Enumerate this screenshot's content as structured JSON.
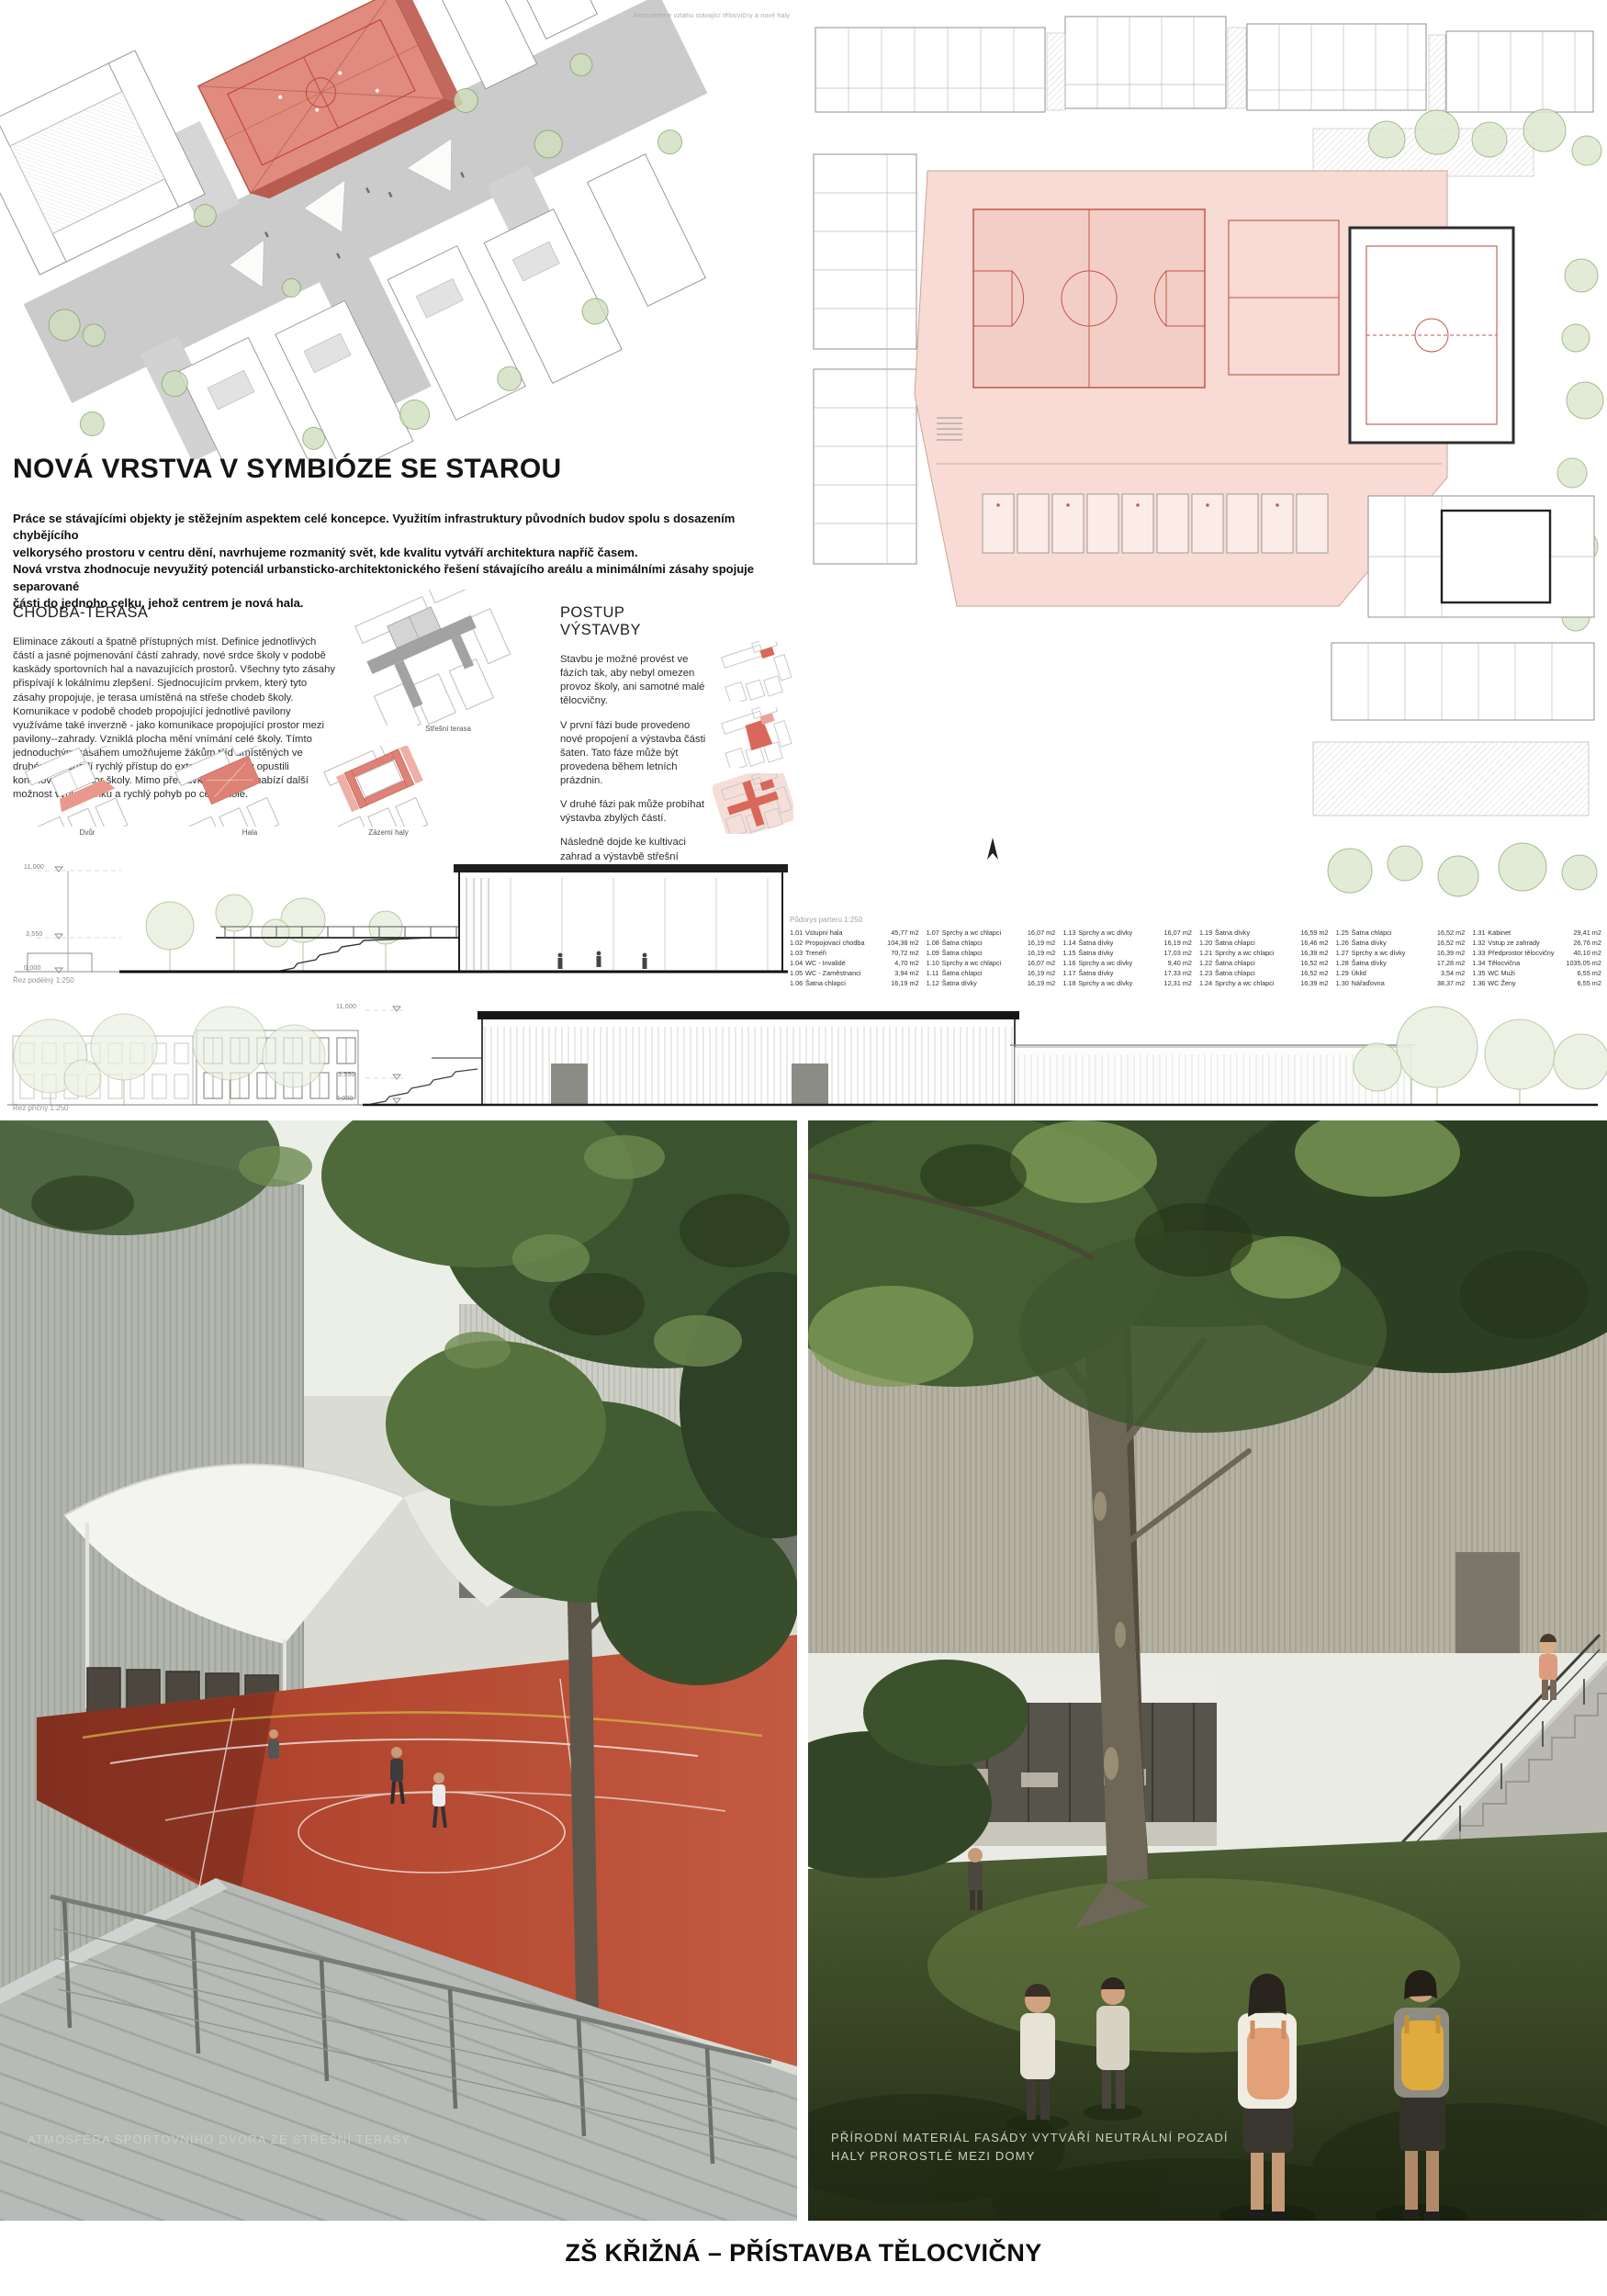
{
  "colors": {
    "accent_red": "#d9796c",
    "plan_pink": "#f7dbd4",
    "court_red": "#b2452f",
    "terrace_gray": "#a2a2a2"
  },
  "axon": {
    "annotation": "Axonometrie vztahu stávající tělocvičny a nové haly"
  },
  "concept": {
    "title": "NOVÁ VRSTVA V SYMBIÓZE SE STAROU",
    "intro": "Práce se stávajícími objekty je stěžejním aspektem celé koncepce. Využitím infrastruktury původních budov spolu s dosazením chybějícího\nvelkorysého prostoru v centru dění, navrhujeme rozmanitý svět, kde kvalitu vytváří architektura napříč časem.\nNová vrstva zhodnocuje nevyužitý potenciál urbansticko-architektonického řešení stávajícího areálu a minimálními zásahy spojuje separované\nčásti do jednoho celku, jehož centrem je nová hala."
  },
  "chodba": {
    "heading": "CHODBA-TERASA",
    "body": "Eliminace zákoutí a špatně přístupných míst. Definice jednotlivých částí a jasné pojmenování částí zahrady, nové srdce školy v podobě kaskády sportovních hal a navazujících prostorů. Všechny tyto zásahy přispívají k lokálnímu zlepšení. Sjednocujícím prvkem, který tyto zásahy propojuje, je terasa umístěná na střeše chodeb školy. Komunikace v podobě chodeb propojující jednotlivé pavilony využíváme také inverzně - jako komunikace propojující prostor mezi pavilony--zahrady. Vzniklá plocha mění vnímání celé školy. Tímto jednoduchým zásahem umožňujeme žákům tříd umístěných ve druhém poschodí rychlý přístup do exteriéru, aniž by opustili kontolovaný prostor školy. Mimo přestávkový provoz nabízí další možnost výuky venku a rychlý pohyb po celé škole."
  },
  "postup": {
    "heading": "POSTUP VÝSTAVBY",
    "paragraphs": [
      "Stavbu je možné provést ve fázích tak, aby nebyl omezen provoz školy, ani samotné malé tělocvičny.",
      "V první fázi bude provedeno nové propojení a výstavba části šaten. Tato fáze může být provedena během letních prázdnin.",
      "V druhé fázi pak může probíhat výstavba zbylých částí.",
      "Následně dojde ke kultivaci zahrad a výstavbě střešní terasy nad stávajícími konstrukcemi."
    ]
  },
  "diagrams": {
    "stresni_label": "Střešní terasa",
    "dvur_label": "Dvůr",
    "hala_label": "Hala",
    "zazemi_label": "Zázemí haly"
  },
  "sections": {
    "rez1_label": "Řez podélný 1:250",
    "rez2_label": "Řez příčný 1:250",
    "levels": [
      "11,000",
      "3,550",
      "0,000"
    ]
  },
  "legend": {
    "title": "Půdorys parteru 1:250",
    "rooms": [
      {
        "id": "1.01",
        "name": "Vstupní hala",
        "area": "45,77 m2"
      },
      {
        "id": "1.02",
        "name": "Propojovací chodba",
        "area": "104,38 m2"
      },
      {
        "id": "1.03",
        "name": "Trenéři",
        "area": "70,72 m2"
      },
      {
        "id": "1.04",
        "name": "WC - Invalidé",
        "area": "4,70 m2"
      },
      {
        "id": "1.05",
        "name": "WC - Zaměstnanci",
        "area": "3,94 m2"
      },
      {
        "id": "1.06",
        "name": "Šatna chlapci",
        "area": "16,19 m2"
      },
      {
        "id": "1.07",
        "name": "Sprchy a wc chlapci",
        "area": "16,07 m2"
      },
      {
        "id": "1.08",
        "name": "Šatna chlapci",
        "area": "16,19 m2"
      },
      {
        "id": "1.09",
        "name": "Šatna chlapci",
        "area": "16,19 m2"
      },
      {
        "id": "1.10",
        "name": "Sprchy a wc chlapci",
        "area": "16,07 m2"
      },
      {
        "id": "1.11",
        "name": "Šatna chlapci",
        "area": "16,19 m2"
      },
      {
        "id": "1.12",
        "name": "Šatna dívky",
        "area": "16,19 m2"
      },
      {
        "id": "1.13",
        "name": "Sprchy a wc dívky",
        "area": "16,07 m2"
      },
      {
        "id": "1.14",
        "name": "Šatna dívky",
        "area": "16,19 m2"
      },
      {
        "id": "1.15",
        "name": "Šatna dívky",
        "area": "17,03 m2"
      },
      {
        "id": "1.16",
        "name": "Sprchy a wc dívky",
        "area": "9,40 m2"
      },
      {
        "id": "1.17",
        "name": "Šatna dívky",
        "area": "17,33 m2"
      },
      {
        "id": "1.18",
        "name": "Sprchy a wc dívky",
        "area": "12,31 m2"
      },
      {
        "id": "1.19",
        "name": "Šatna dívky",
        "area": "16,59 m2"
      },
      {
        "id": "1.20",
        "name": "Šatna chlapci",
        "area": "16,46 m2"
      },
      {
        "id": "1.21",
        "name": "Sprchy a wc chlapci",
        "area": "16,39 m2"
      },
      {
        "id": "1.22",
        "name": "Šatna chlapci",
        "area": "16,52 m2"
      },
      {
        "id": "1.23",
        "name": "Šatna chlapci",
        "area": "16,52 m2"
      },
      {
        "id": "1.24",
        "name": "Sprchy a wc chlapci",
        "area": "16,39 m2"
      },
      {
        "id": "1.25",
        "name": "Šatna chlapci",
        "area": "16,52 m2"
      },
      {
        "id": "1.26",
        "name": "Šatna dívky",
        "area": "16,52 m2"
      },
      {
        "id": "1.27",
        "name": "Sprchy a wc dívky",
        "area": "16,39 m2"
      },
      {
        "id": "1.28",
        "name": "Šatna dívky",
        "area": "17,28 m2"
      },
      {
        "id": "1.29",
        "name": "Úklid",
        "area": "3,54 m2"
      },
      {
        "id": "1.30",
        "name": "Nářaďovna",
        "area": "38,37 m2"
      },
      {
        "id": "1.31",
        "name": "Kabinet",
        "area": "29,41 m2"
      },
      {
        "id": "1.32",
        "name": "Vstup ze zahrady",
        "area": "26,76 m2"
      },
      {
        "id": "1.33",
        "name": "Předprostor tělocvičny",
        "area": "40,10 m2"
      },
      {
        "id": "1.34",
        "name": "Tělocvična",
        "area": "1035,05 m2"
      },
      {
        "id": "1.35",
        "name": "WC Muži",
        "area": "6,55 m2"
      },
      {
        "id": "1.36",
        "name": "WC Ženy",
        "area": "6,55 m2"
      }
    ]
  },
  "renders": {
    "left_caption": "ATMOSFÉRA SPORTOVNÍHO DVORA ZE STŘEŠNÍ TERASY",
    "right_caption_line1": "PŘÍRODNÍ MATERIÁL FASÁDY VYTVÁŘÍ NEUTRÁLNÍ POZADÍ",
    "right_caption_line2": "HALY PROROSTLÉ MEZI DOMY"
  },
  "footer": {
    "title": "ZŠ KŘIŽNÁ – PŘÍSTAVBA TĚLOCVIČNY"
  }
}
